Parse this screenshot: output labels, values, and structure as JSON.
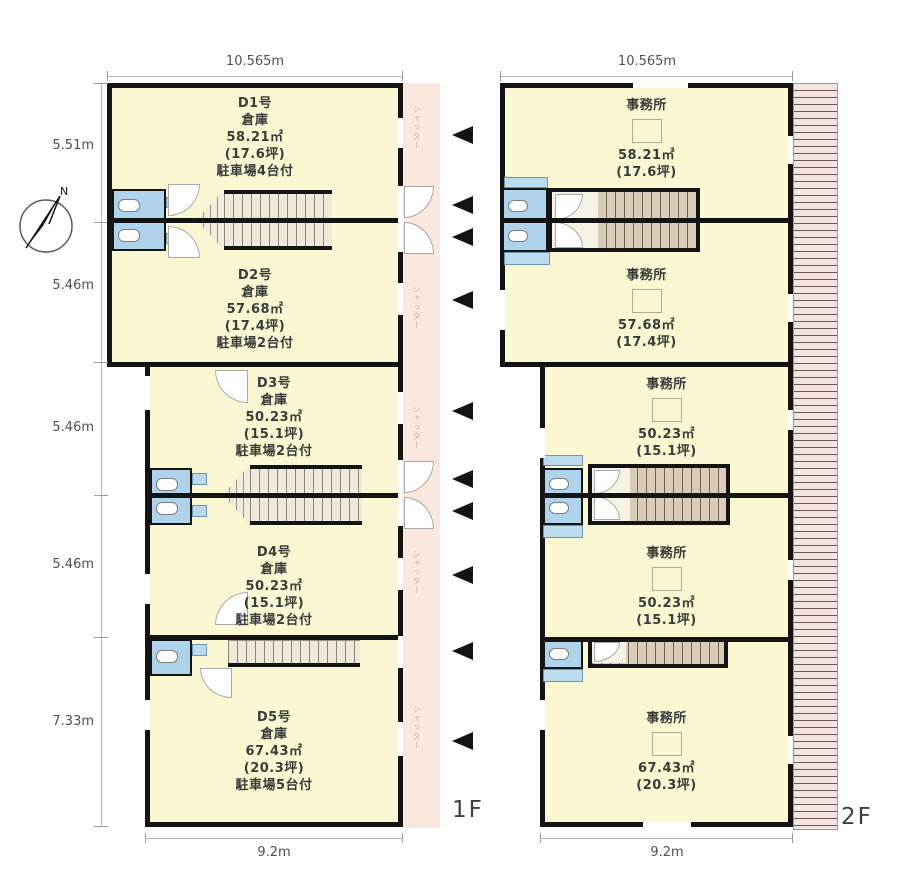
{
  "compass": {
    "north_label": "N"
  },
  "dimensions": {
    "floor1_top_width": "10.565m",
    "floor2_top_width": "10.565m",
    "floor1_bottom_width": "9.2m",
    "floor2_bottom_width": "9.2m",
    "left_heights": [
      "5.51m",
      "5.46m",
      "5.46m",
      "5.46m",
      "7.33m"
    ]
  },
  "floor1": {
    "label": "1F",
    "shutter_label": "シャッター",
    "units": [
      {
        "name": "D1号",
        "type": "倉庫",
        "area": "58.21㎡",
        "tsubo": "(17.6坪)",
        "parking": "駐車場4台付"
      },
      {
        "name": "D2号",
        "type": "倉庫",
        "area": "57.68㎡",
        "tsubo": "(17.4坪)",
        "parking": "駐車場2台付"
      },
      {
        "name": "D3号",
        "type": "倉庫",
        "area": "50.23㎡",
        "tsubo": "(15.1坪)",
        "parking": "駐車場2台付"
      },
      {
        "name": "D4号",
        "type": "倉庫",
        "area": "50.23㎡",
        "tsubo": "(15.1坪)",
        "parking": "駐車場2台付"
      },
      {
        "name": "D5号",
        "type": "倉庫",
        "area": "67.43㎡",
        "tsubo": "(20.3坪)",
        "parking": "駐車場5台付"
      }
    ]
  },
  "floor2": {
    "label": "2F",
    "units": [
      {
        "name": "事務所",
        "area": "58.21㎡",
        "tsubo": "(17.6坪)"
      },
      {
        "name": "事務所",
        "area": "57.68㎡",
        "tsubo": "(17.4坪)"
      },
      {
        "name": "事務所",
        "area": "50.23㎡",
        "tsubo": "(15.1坪)"
      },
      {
        "name": "事務所",
        "area": "50.23㎡",
        "tsubo": "(15.1坪)"
      },
      {
        "name": "事務所",
        "area": "67.43㎡",
        "tsubo": "(20.3坪)"
      }
    ]
  },
  "colors": {
    "room_fill": "#fbf7d2",
    "wall": "#141414",
    "wc_fill": "#aed3ea",
    "corridor_fill": "#fae8df",
    "balcony_fill": "#f4e4e0",
    "stair_fill_1f": "#f0e9da",
    "stair_fill_2f": "#d9cdb9"
  }
}
